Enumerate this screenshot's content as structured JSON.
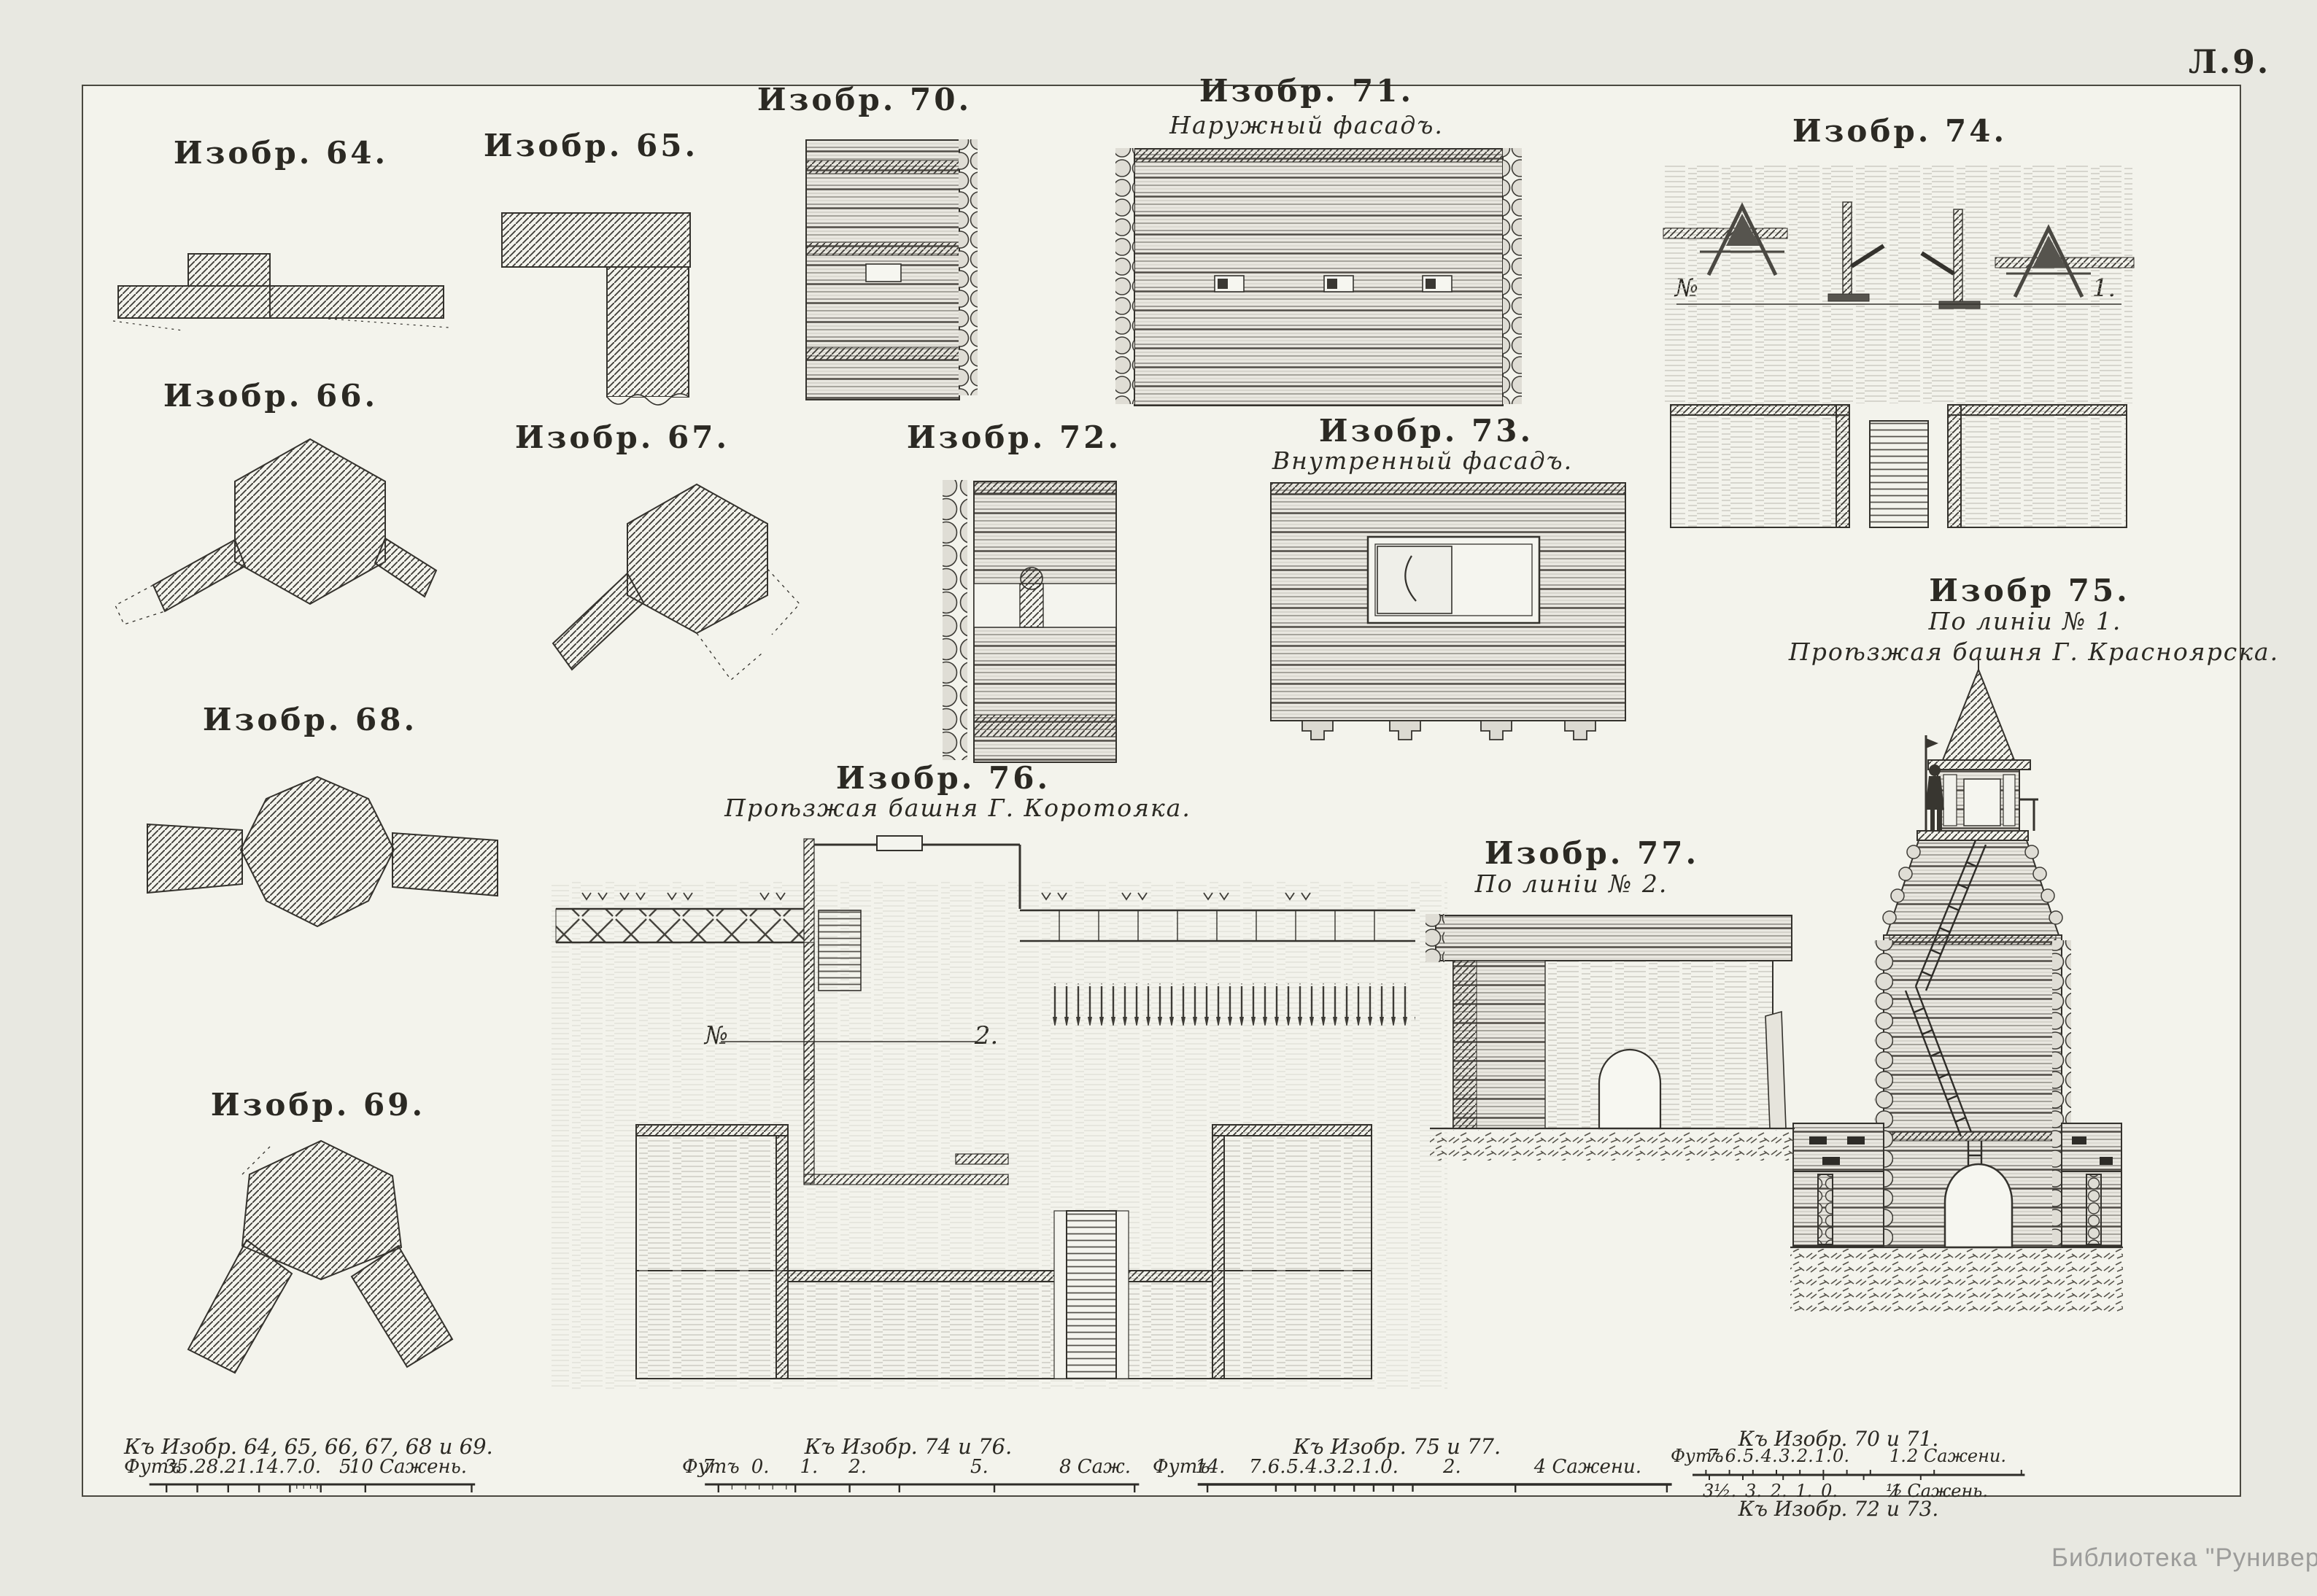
{
  "page": {
    "sheet_number": "Л.9.",
    "credit": "Библиотека \"Руниверс\""
  },
  "colors": {
    "paper": "#f3f3ec",
    "page_background": "#e8e8e1",
    "ink": "#2b2923",
    "credit_gray": "#9c9c9a"
  },
  "figures": {
    "fig64": {
      "title": "Изобр. 64."
    },
    "fig65": {
      "title": "Изобр. 65."
    },
    "fig66": {
      "title": "Изобр. 66."
    },
    "fig67": {
      "title": "Изобр. 67."
    },
    "fig68": {
      "title": "Изобр. 68."
    },
    "fig69": {
      "title": "Изобр. 69."
    },
    "fig70": {
      "title": "Изобр. 70."
    },
    "fig71": {
      "title": "Изобр. 71.",
      "subtitle": "Наружный фасадъ."
    },
    "fig72": {
      "title": "Изобр. 72."
    },
    "fig73": {
      "title": "Изобр. 73.",
      "subtitle": "Внутренный фасадъ."
    },
    "fig74": {
      "title": "Изобр. 74.",
      "section_start": "№",
      "section_end": "1."
    },
    "fig75": {
      "title": "Изобр 75.",
      "subtitle": "По линіи № 1.",
      "caption": "Проѣзжая башня Г. Красноярска."
    },
    "fig76": {
      "title": "Изобр. 76.",
      "caption": "Проѣзжая башня Г. Коротояка.",
      "section_start": "№",
      "section_end": "2."
    },
    "fig77": {
      "title": "Изобр. 77.",
      "subtitle": "По линіи № 2."
    }
  },
  "scales": [
    {
      "title": "Къ Изобр. 64, 65, 66, 67, 68 и 69.",
      "left_label": "Футъ",
      "ticks": [
        "35.",
        "28.",
        "21.",
        "14.",
        "7.",
        "0."
      ],
      "mid_tick": "5.",
      "right_label": "10 Сажень."
    },
    {
      "title": "Къ Изобр. 74 и 76.",
      "left_label": "Футъ",
      "ticks": [
        "7.",
        "0.",
        "1.",
        "2."
      ],
      "mid_tick": "5.",
      "right_label": "8 Саж."
    },
    {
      "title": "Къ Изобр. 75 и 77.",
      "left_label": "Футъ",
      "first_tick": "14.",
      "ticks": [
        "7.",
        "6.",
        "5.",
        "4.",
        "3.",
        "2.",
        "1.",
        "0."
      ],
      "mid_tick": "2.",
      "right_label": "4 Сажени."
    },
    {
      "title": "Къ Изобр. 70 и 71.",
      "left_label": "Футъ",
      "ticks": [
        "7.",
        "6.",
        "5.",
        "4.",
        "3.",
        "2.",
        "1.",
        "0."
      ],
      "mid_tick": "1.",
      "right_label": "2 Сажени."
    },
    {
      "title": "Къ Изобр. 72 и 73.",
      "ticks": [
        "3½.",
        "3.",
        "2.",
        "1.",
        "0."
      ],
      "mid_tick": "½",
      "right_label": "1 Сажень."
    }
  ]
}
